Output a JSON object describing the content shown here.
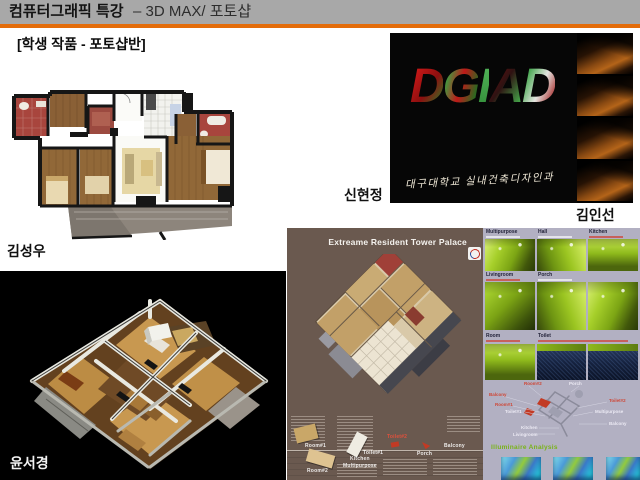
{
  "header": {
    "title_strong": "컴퓨터그래픽 특강",
    "title_rest": "– 3D MAX/ 포토샵"
  },
  "subtitle": "[학생 작품 - 포토샵반]",
  "students": {
    "floorplan_author": "김성우",
    "dgiad_author_left": "신현정",
    "dgiad_author_right": "김인선",
    "axon_author": "윤서경"
  },
  "dgiad": {
    "letters": [
      "D",
      "G",
      "I",
      "A",
      "D"
    ],
    "caption": "대구대학교 실내건축디자인과"
  },
  "poster": {
    "title": "Extreame Resident Tower Palace",
    "labels": {
      "room1": "Room#1",
      "room2": "Room#2",
      "kitchen": "Kitchen",
      "multipurpose": "Multipurpose",
      "toilet1": "Toilet#1",
      "toilet2": "Toilet#2",
      "porch": "Porch",
      "balcony": "Balcony"
    }
  },
  "gallery": {
    "row1": [
      "Multipurpose",
      "Hall",
      "Kitchen"
    ],
    "row2": [
      "Livingroom",
      "Porch"
    ],
    "row3": [
      "Room",
      "Toilet"
    ],
    "analysis_title": "Illuminaire Analysis",
    "diagram": {
      "room2": "Room#2",
      "porch": "Porch",
      "balcony_left": "Balcony",
      "room1": "Room#1",
      "toilet1": "Toilet#1",
      "toilet2": "Toilet#2",
      "multipurpose": "Multipurpose",
      "balcony_right": "Balcony",
      "kitchen": "Kitchen",
      "livingroom": "Livingroom"
    }
  },
  "colors": {
    "accent_orange": "#e36c0a",
    "header_gray": "#a8a8a8",
    "poster_brown": "#6a594f",
    "gallery_background": "#b2b0c2",
    "highlight_green": "#96c41e"
  }
}
